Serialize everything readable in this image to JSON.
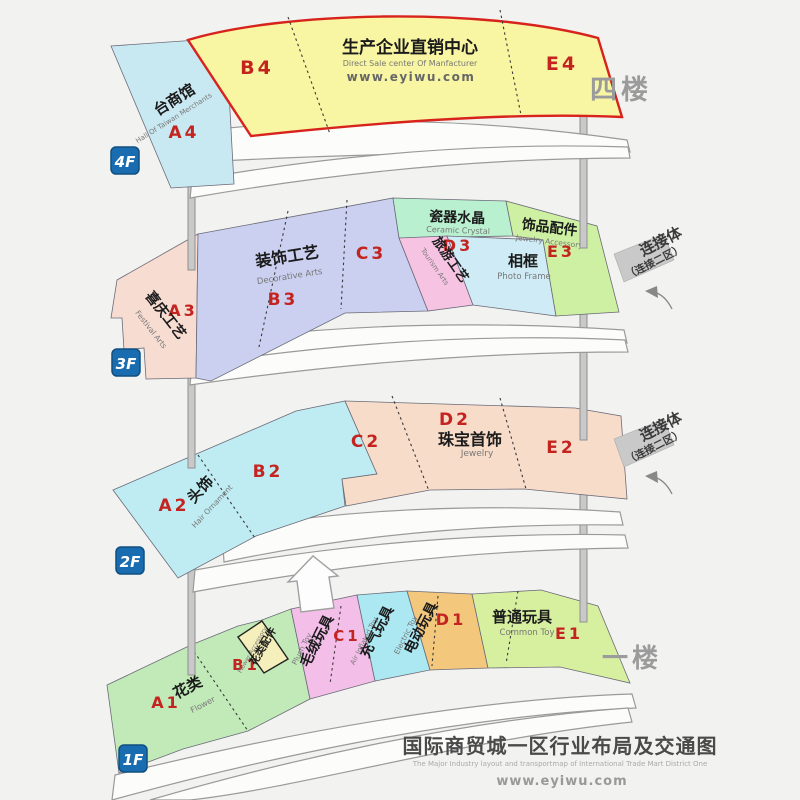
{
  "colors": {
    "bg": "#f2f2f0",
    "code_red": "#c42420",
    "cn_text": "#1b1b1b",
    "en_text": "#777777",
    "side_gray": "#9b9b9b",
    "badge_fill": "#1a6cb0",
    "badge_stroke": "#0f4f80",
    "badge_text": "#ffffff",
    "band_fill": "#fcfcfb",
    "band_stroke": "#9a9a9a",
    "pillar_fill": "#c9c9c9",
    "red_border": "#d8231d",
    "connector_gray": "#c9c9c9",
    "arrow_fill": "#fdfdfd",
    "zone_blue4": "#c9e9f2",
    "zone_yellow4": "#f8f6a2",
    "zone_peach3": "#f7dcd2",
    "zone_lavender3": "#cbd0f0",
    "zone_mint3": "#b9f0d0",
    "zone_pink3": "#f7c3e3",
    "zone_cyan3": "#cfecf6",
    "zone_green3": "#cdf0a2",
    "zone_cyan2": "#bfecf2",
    "zone_peach2": "#f8dcca",
    "zone_green_a1": "#c1eab8",
    "zone_yellow_b1": "#f5f0bb",
    "zone_pink1": "#f3bfe9",
    "zone_cyan1": "#abe8f2",
    "zone_orange1": "#f3c77c",
    "zone_green_e1": "#d7f0a0"
  },
  "floor4": {
    "badge": "4F",
    "side_label": "四楼",
    "a4": "A4",
    "b4": "B4",
    "e4": "E4",
    "taiwan_cn": "台商馆",
    "taiwan_en": "Hall Of Taiwan Merchants",
    "center_cn": "生产企业直销中心",
    "center_en": "Direct Sale center Of Manfacturer",
    "center_url": "www.eyiwu.com"
  },
  "floor3": {
    "badge": "3F",
    "a3": "A3",
    "b3": "B3",
    "c3": "C3",
    "d3": "D3",
    "e3": "E3",
    "festival_cn": "喜庆工艺",
    "festival_en": "Festival Arts",
    "decor_cn": "装饰工艺",
    "decor_en": "Decorative Arts",
    "ceramic_cn": "瓷器水晶",
    "ceramic_en": "Ceramic Crystal",
    "tourism_cn": "旅游工艺",
    "tourism_en": "Tourism Arts",
    "photo_cn": "相框",
    "photo_en": "Photo Frame",
    "jewelry_acc_cn": "饰品配件",
    "jewelry_acc_en": "Jewelry Accessory",
    "connector_l1": "连接体",
    "connector_l2": "（连接二区）"
  },
  "floor2": {
    "badge": "2F",
    "a2": "A2",
    "b2": "B2",
    "c2": "C2",
    "d2": "D2",
    "e2": "E2",
    "hair_cn": "头饰",
    "hair_en": "Hair Ornament",
    "jewelry_cn": "珠宝首饰",
    "jewelry_en": "Jewelry",
    "connector_l1": "连接体",
    "connector_l2": "（连接二区）"
  },
  "floor1": {
    "badge": "1F",
    "side_label": "一楼",
    "a1": "A1",
    "b1": "B1",
    "c1": "C1",
    "d1": "D1",
    "e1": "E1",
    "flower_cn": "花类",
    "flower_en": "Flower",
    "flower_acc_cn": "花类配件",
    "flower_acc_en": "Flower Accessory",
    "plush_cn": "毛绒玩具",
    "plush_en": "Plush Toy",
    "air_cn": "充气玩具",
    "air_en": "Air Inflated Toy",
    "electric_cn": "电动玩具",
    "electric_en": "Electric Toy",
    "common_cn": "普通玩具",
    "common_en": "Common Toy"
  },
  "footer": {
    "title_cn": "国际商贸城一区行业布局及交通图",
    "title_en": "The Major Industry layout and transportmap of International Trade Mart District One",
    "url": "www.eyiwu.com"
  }
}
